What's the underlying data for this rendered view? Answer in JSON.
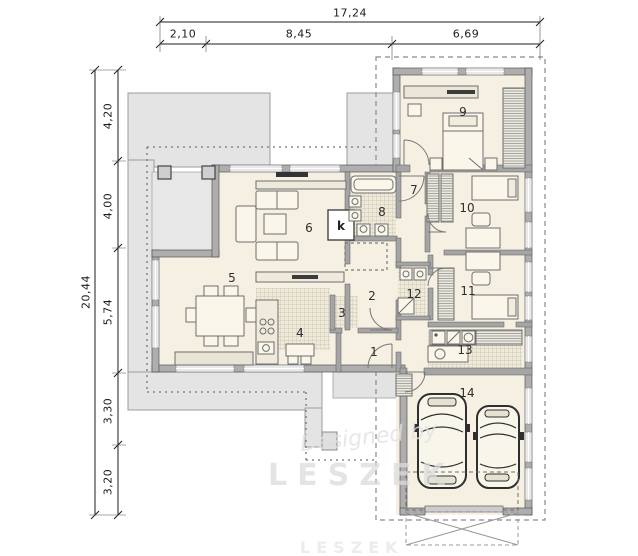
{
  "dimensions": {
    "top": {
      "total": "17,24",
      "segments": [
        "2,10",
        "8,45",
        "6,69"
      ]
    },
    "left": {
      "total": "20,44",
      "segments": [
        "4,20",
        "4,00",
        "5,74",
        "3,30",
        "3,20"
      ]
    }
  },
  "rooms": [
    {
      "number": "1"
    },
    {
      "number": "2"
    },
    {
      "number": "3"
    },
    {
      "number": "4"
    },
    {
      "number": "5"
    },
    {
      "number": "6"
    },
    {
      "number": "7"
    },
    {
      "number": "8"
    },
    {
      "number": "9"
    },
    {
      "number": "10"
    },
    {
      "number": "11"
    },
    {
      "number": "12"
    },
    {
      "number": "13"
    },
    {
      "number": "14"
    }
  ],
  "fireplace_label": "k",
  "watermark": {
    "name": "LESZEK",
    "script": "Designed by",
    "bottom": "LESZEK"
  },
  "colors": {
    "floor": "#f6f0e2",
    "terrace": "#e4e4e5",
    "wall": "#aeaeae",
    "line": "#4a4a4a"
  }
}
